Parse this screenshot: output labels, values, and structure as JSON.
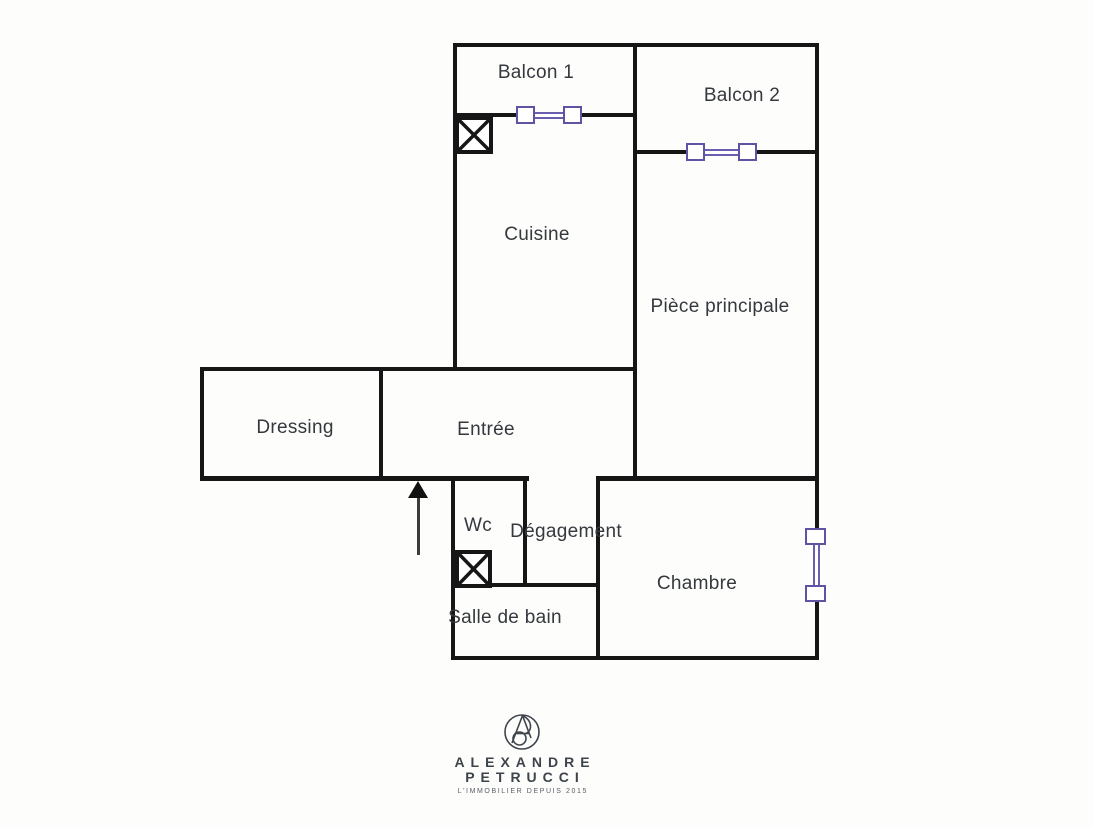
{
  "document": {
    "kind": "floor-plan",
    "background": "#fdfdfc"
  },
  "colors": {
    "wall": "#161616",
    "window_accent": "#5f54a4",
    "label_text": "#35383d",
    "logo_text": "#3e444b"
  },
  "rooms": [
    {
      "id": "balcon-1",
      "label": "Balcon 1"
    },
    {
      "id": "balcon-2",
      "label": "Balcon 2"
    },
    {
      "id": "cuisine",
      "label": "Cuisine"
    },
    {
      "id": "piece-principale",
      "label": "Pièce principale"
    },
    {
      "id": "dressing",
      "label": "Dressing"
    },
    {
      "id": "entree",
      "label": "Entrée"
    },
    {
      "id": "wc",
      "label": "Wc"
    },
    {
      "id": "degagement",
      "label": "Dégagement"
    },
    {
      "id": "salle-de-bain",
      "label": "Salle de bain"
    },
    {
      "id": "chambre",
      "label": "Chambre"
    }
  ],
  "symbols": {
    "windows": [
      "balcon-1-window",
      "balcon-2-window",
      "chambre-window"
    ],
    "shafts": [
      "cuisine-shaft",
      "wc-shaft"
    ],
    "entrance_arrow": "entrance-direction"
  },
  "logo": {
    "name_line1": "ALEXANDRE",
    "name_line2": "PETRUCCI",
    "tagline": "L'IMMOBILIER DEPUIS 2015"
  }
}
